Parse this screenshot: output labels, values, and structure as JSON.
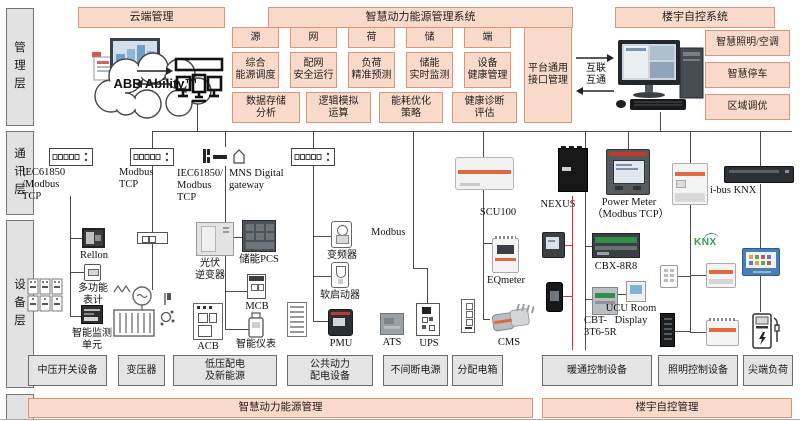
{
  "layers": [
    "管\n理\n层",
    "通\n讯\n层",
    "设\n备\n层"
  ],
  "headers": {
    "cloud": "云端管理",
    "energy": "智慧动力能源管理系统",
    "building": "楼宇自控系统"
  },
  "cloud_brand": "ABB Ability™",
  "mgmt": {
    "r1": [
      "源",
      "网",
      "荷",
      "储",
      "端"
    ],
    "r2": [
      "综合\n能源调度",
      "配网\n安全运行",
      "负荷\n精准预测",
      "储能\n实时监测",
      "设备\n健康管理"
    ],
    "r3": [
      "数据存储\n分析",
      "逻辑模拟\n运算",
      "能耗优化\n策略",
      "健康诊断\n评估"
    ],
    "platform": "平台通用\n接口管理",
    "interconnect": "互联\n互通",
    "building": [
      "智慧照明/空调",
      "智慧停车",
      "区域调优"
    ]
  },
  "comm": {
    "sw1": "IEC61850\n/Modbus\nTCP",
    "sw2": "Modbus\nTCP",
    "sw3a": "IEC61850/\nModbus\nTCP",
    "sw3b": "MNS Digital\ngateway",
    "modbus": "Modbus",
    "scu": "SCU100",
    "nexus": "NEXUS",
    "powermeter": "Power Meter\n（Modbus TCP）",
    "ibus": "i-bus KNX",
    "knx": "KNX"
  },
  "devices": {
    "rellon": "Rellon",
    "multimeter": "多功能\n表计",
    "monitor_unit": "智能监测\n单元",
    "pv": "光伏\n逆变器",
    "pcs": "储能PCS",
    "mcb": "MCB",
    "acb": "ACB",
    "smart_meter": "智能仪表",
    "vfd": "变频器",
    "softstarter": "软启动器",
    "pmu": "PMU",
    "ats": "ATS",
    "ups": "UPS",
    "eqmeter": "EQmeter",
    "cms": "CMS",
    "cbx": "CBX-8R8",
    "ucu": "UCU Room\nDisplay",
    "cbt": "CBT-\n3T6-5R"
  },
  "bottom": {
    "categories": [
      "中压开关设备",
      "变压器",
      "低压配电\n及新能源",
      "公共动力\n配电设备",
      "不间断电源",
      "分配电箱",
      "暖通控制设备",
      "照明控制设备",
      "尖端负荷"
    ],
    "bands": [
      "智慧动力能源管理",
      "楼宇自控管理"
    ]
  },
  "icons": {
    "screens-icon": "monitor cluster",
    "cloud-icon": "cloud outline",
    "server-icon": "scada workstation",
    "desktop-computer-icon": "desktop pc",
    "switch-icon": "network switch",
    "gateway-icon": "mns gateway",
    "transformer-icon": "transformer",
    "ev-charger-icon": "ev charger",
    "knx-logo": "KNX"
  },
  "colors": {
    "box_pink": "#f9d9ca",
    "box_pink_border": "#dd9579",
    "box_gray": "#e4e4e4",
    "line": "#444444",
    "red_line": "#cc392c",
    "knx_green": "#2f9e45"
  }
}
